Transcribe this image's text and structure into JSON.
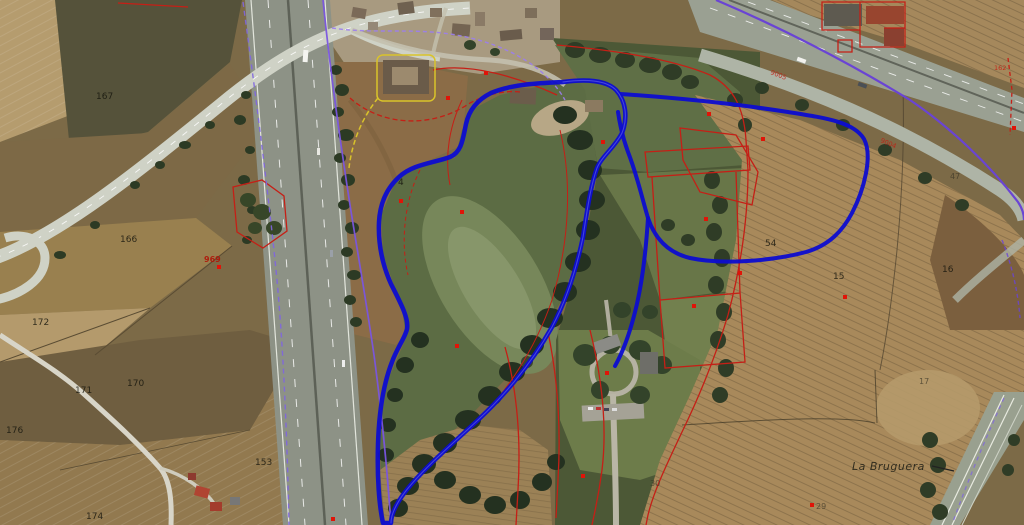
{
  "map": {
    "parcel_labels": [
      {
        "text": "167"
      },
      {
        "text": "166"
      },
      {
        "text": "172"
      },
      {
        "text": "171"
      },
      {
        "text": "170"
      },
      {
        "text": "176"
      },
      {
        "text": "153"
      },
      {
        "text": "174"
      },
      {
        "text": "4"
      },
      {
        "text": "54"
      },
      {
        "text": "15"
      },
      {
        "text": "16"
      },
      {
        "text": "47"
      },
      {
        "text": "17"
      },
      {
        "text": "30"
      },
      {
        "text": "29"
      }
    ],
    "red_labels": [
      {
        "text": "969"
      },
      {
        "text": "9005"
      },
      {
        "text": "9004"
      },
      {
        "text": "162"
      }
    ],
    "place_labels": [
      {
        "text": "La Bruguera"
      }
    ],
    "overlay_colors": {
      "selection_blue": "#0d0dd0",
      "cadastral_red": "#c51f16",
      "boundary_purple": "#7a57e8",
      "highlight_yellow": "#d9c32a"
    }
  }
}
